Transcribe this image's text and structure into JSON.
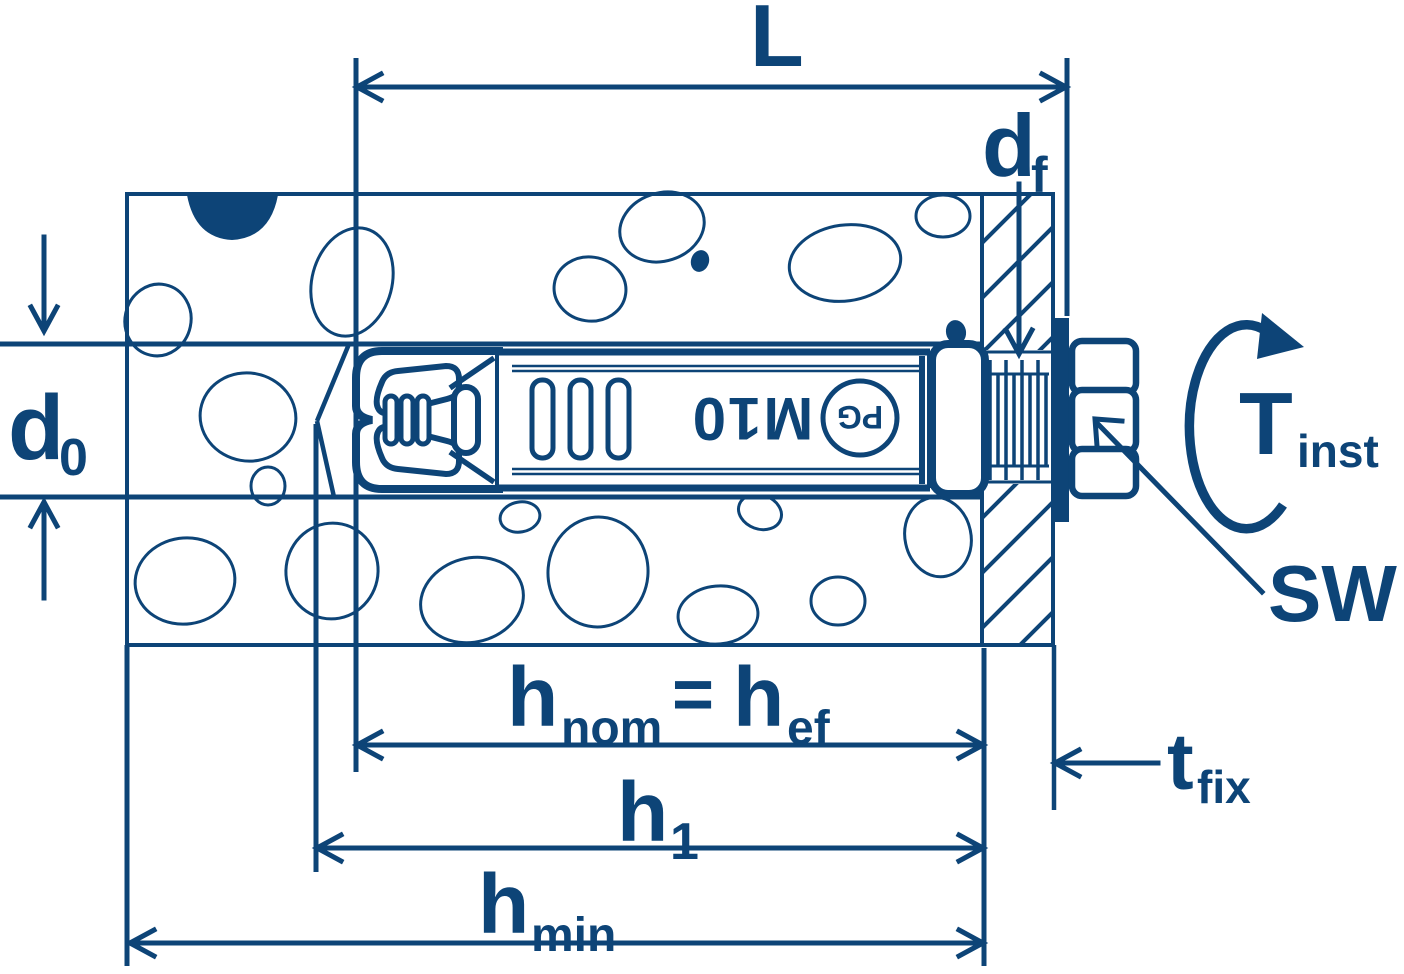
{
  "diagram": {
    "colors": {
      "ink": "#0d4477",
      "background": "#ffffff"
    },
    "labels": {
      "length": "L",
      "df": {
        "base": "d",
        "sub": "f"
      },
      "d0": {
        "base": "d",
        "sub": "0"
      },
      "hnom": {
        "base": "h",
        "sub": "nom"
      },
      "equals": "=",
      "hef": {
        "base": "h",
        "sub": "ef"
      },
      "h1": {
        "base": "h",
        "sub": "1"
      },
      "hmin": {
        "base": "h",
        "sub": "min"
      },
      "tfix": {
        "base": "t",
        "sub": "fix"
      },
      "tinst": {
        "base": "T",
        "sub": "inst"
      },
      "sw": "SW"
    },
    "anchor_markings": {
      "size": "M10",
      "logo": "PG"
    },
    "icons": {
      "torque_rotation": "curved-rotation-arrow",
      "dimension_arrows": "open-v-arrowheads"
    }
  }
}
